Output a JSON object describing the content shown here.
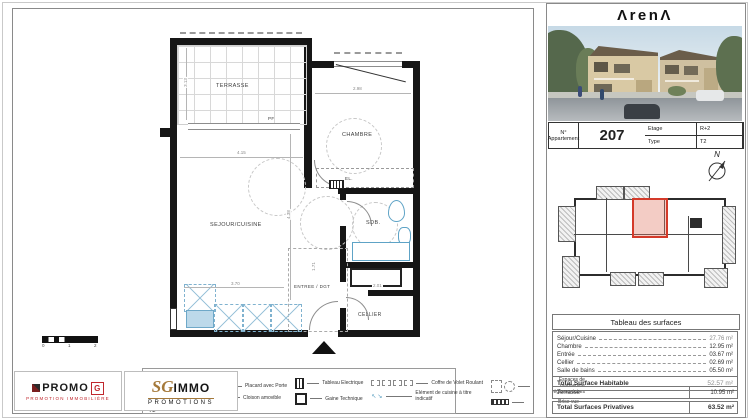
{
  "plan": {
    "rooms": {
      "terrasse": "TERRASSE",
      "sejour": "SEJOUR/CUISINE",
      "chambre": "CHAMBRE",
      "sdb": "SDB.",
      "entree": "ENTREE / DGT",
      "cellier": "CELLIER",
      "el": "EL."
    },
    "pf_label": "PF",
    "dimensions": {
      "sejour_w": "4.15",
      "chambre_w": "2.98",
      "sejour_h": "4.38",
      "kitchen_w": "3.70",
      "entree_h": "1.71",
      "cellier_w": "2.01",
      "terrasse_h": "3.13"
    }
  },
  "scalebar": {
    "t0": "0",
    "t1": "1",
    "t2": "2"
  },
  "legend": {
    "title": "Légende",
    "abbrev": [
      {
        "abbr": "PF",
        "label": "Porte Fenêtre"
      },
      {
        "abbr": "F",
        "label": "Fenêtre"
      },
      {
        "abbr": "Pl",
        "label": "Placard"
      }
    ],
    "items": [
      {
        "icon": "cumulus",
        "label": "Cumulus"
      },
      {
        "icon": "placard-avec-porte",
        "label": "Placard avec Porte"
      },
      {
        "icon": "cloison-amovible",
        "label": "Cloison amovible"
      },
      {
        "icon": "tableau-electrique",
        "label": "Tableau Electrique"
      },
      {
        "icon": "gaine-technique",
        "label": "Gaine Technique"
      },
      {
        "icon": "coffre-volet-roulant",
        "label": "Coffre de Volet Roulant"
      },
      {
        "icon": "espaces-manoeuvre",
        "label": "Espaces de manoeuvre réglementaires"
      },
      {
        "icon": "element-cuisine",
        "label": "Elément de cuisine à titre indicatif"
      },
      {
        "icon": "brise-vue",
        "label": "Brise vue"
      }
    ]
  },
  "logos": {
    "promo": {
      "name": "PROMO",
      "g": "G",
      "tagline": "PROMOTION IMMOBILIÈRE"
    },
    "sg": {
      "sg": "SG",
      "immo": "IMMO",
      "sub": "PROMOTIONS"
    }
  },
  "panel": {
    "brand": "ΛrenΛ",
    "compass_n": "N",
    "info": {
      "etage_label": "Etage",
      "etage": "R+2",
      "type_label": "Type",
      "type": "T2",
      "apt_label": "N° Appartement",
      "apt": "207"
    },
    "surfaces": {
      "title": "Tableau des surfaces",
      "rows": [
        {
          "label": "Séjour/Cuisine",
          "value": "27.76 m²"
        },
        {
          "label": "Chambre",
          "value": "12.95 m²"
        },
        {
          "label": "Entrée",
          "value": "03.67 m²"
        },
        {
          "label": "Cellier",
          "value": "02.69 m²"
        },
        {
          "label": "Salle de bains",
          "value": "05.50 m²"
        }
      ],
      "total_hab_label": "Total Surface Habitable",
      "total_hab": "52.57 m²",
      "terrasse_label": "Terrasse",
      "terrasse": "10.95 m²",
      "total_priv_label": "Total Surfaces Privatives",
      "total_priv": "63.52 m²"
    }
  },
  "colors": {
    "wall": "#161616",
    "fixture": "#5ea3c6",
    "unit_highlight": "#d43a2a"
  }
}
